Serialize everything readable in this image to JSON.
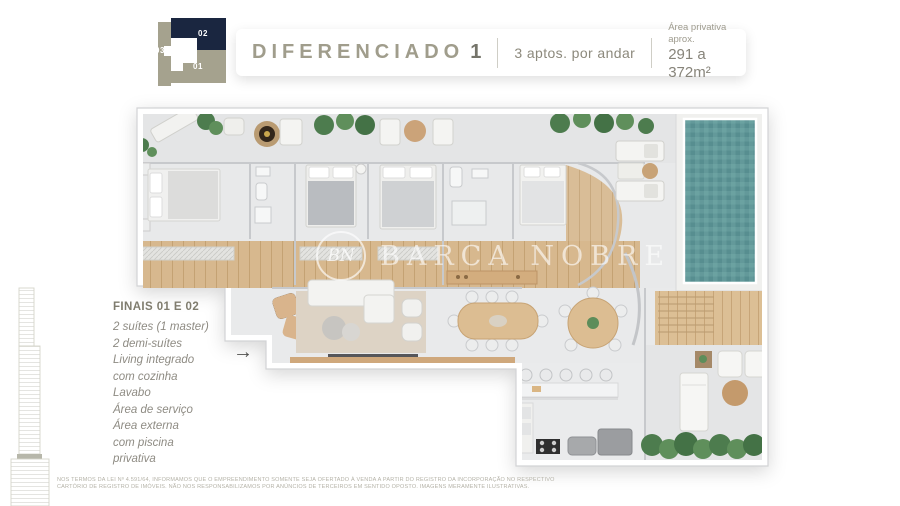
{
  "keyplan": {
    "unit_01": "01",
    "unit_02": "02",
    "unit_03": "03",
    "navy_color": "#1a2640",
    "khaki_color": "#a5a28e"
  },
  "header": {
    "title": "DIFERENCIADO",
    "title_number": "1",
    "subtitle": "3 aptos. por andar",
    "area_label": "Área privativa aprox.",
    "area_value": "291 a 372m²",
    "title_color": "#a09d8c"
  },
  "info": {
    "heading": "FINAIS 01 E 02",
    "lines": [
      "2 suítes (1 master)",
      "2 demi-suítes",
      "Living integrado",
      "com cozinha",
      "Lavabo",
      "Área de serviço",
      "Área externa",
      "com piscina",
      "privativa"
    ]
  },
  "entry_arrow": "→",
  "watermark": {
    "monogram": "BN",
    "name": "BARCA NOBRE"
  },
  "floorplan_colors": {
    "floor": "#e8e9ea",
    "wood": "#d7b88e",
    "pool": "#63999a",
    "plants": "#4d7c4e",
    "walls": "#c7c9cc"
  },
  "disclaimer": {
    "line1": "NOS TERMOS DA LEI Nº 4.591/64, INFORMAMOS QUE O EMPREENDIMENTO SOMENTE SEJA OFERTADO À VENDA A PARTIR DO REGISTRO DA INCORPORAÇÃO NO RESPECTIVO",
    "line2": "CARTÓRIO DE REGISTRO DE IMÓVEIS. NÃO NOS RESPONSABILIZAMOS POR ANÚNCIOS DE TERCEIROS EM SENTIDO OPOSTO. IMAGENS MERAMENTE ILUSTRATIVAS."
  }
}
